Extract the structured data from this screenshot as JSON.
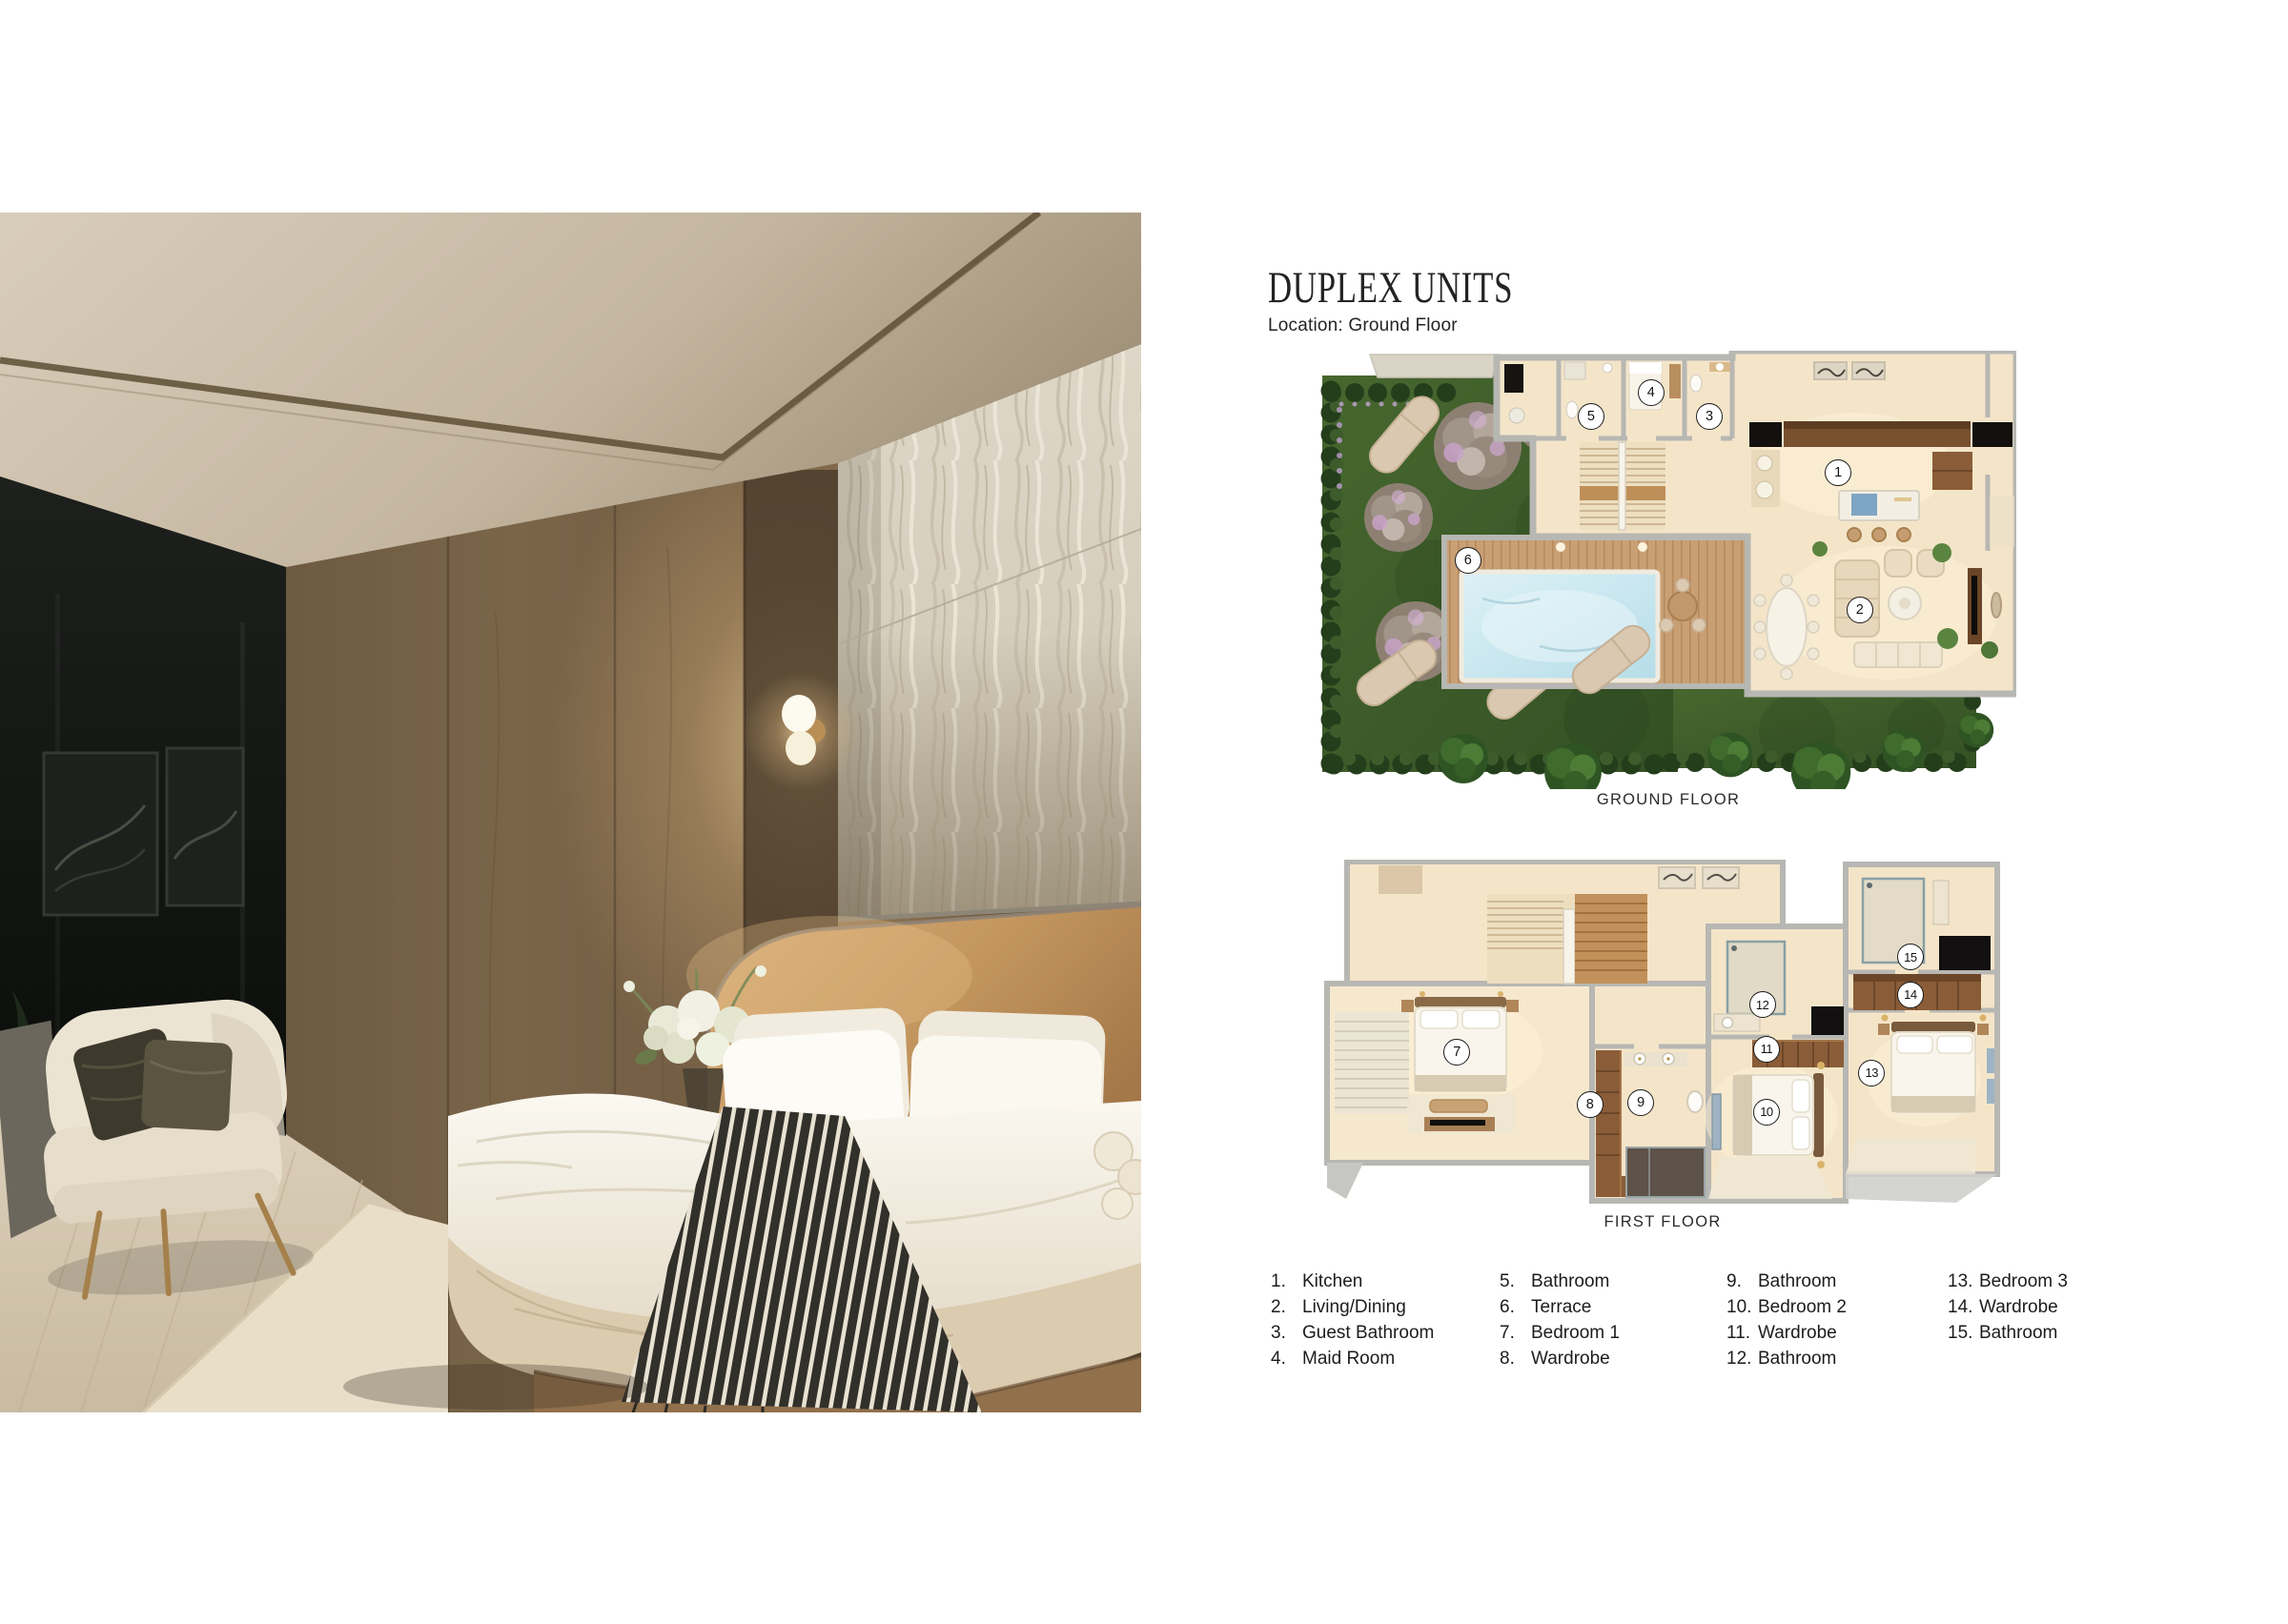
{
  "header": {
    "title": "DUPLEX UNITS",
    "location": "Location: Ground Floor"
  },
  "plans": {
    "ground": {
      "caption": "GROUND FLOOR",
      "markers": [
        {
          "n": "1",
          "x": 74.4,
          "y": 27.8
        },
        {
          "n": "2",
          "x": 77.5,
          "y": 59.1
        },
        {
          "n": "3",
          "x": 55.9,
          "y": 15.0
        },
        {
          "n": "4",
          "x": 47.5,
          "y": 9.6
        },
        {
          "n": "5",
          "x": 38.9,
          "y": 15.0
        },
        {
          "n": "6",
          "x": 21.2,
          "y": 47.8
        }
      ]
    },
    "first": {
      "caption": "FIRST FLOOR",
      "markers": [
        {
          "n": "7",
          "x": 19.7,
          "y": 55.7
        },
        {
          "n": "8",
          "x": 39.3,
          "y": 70.8
        },
        {
          "n": "9",
          "x": 46.8,
          "y": 70.2
        },
        {
          "n": "10",
          "x": 65.3,
          "y": 73.0
        },
        {
          "n": "11",
          "x": 65.3,
          "y": 54.8
        },
        {
          "n": "12",
          "x": 64.7,
          "y": 41.9
        },
        {
          "n": "13",
          "x": 80.8,
          "y": 61.7
        },
        {
          "n": "14",
          "x": 86.5,
          "y": 39.1
        },
        {
          "n": "15",
          "x": 86.5,
          "y": 28.1
        }
      ]
    }
  },
  "legend": {
    "columns": [
      [
        {
          "n": "1.",
          "label": "Kitchen"
        },
        {
          "n": "2.",
          "label": "Living/Dining"
        },
        {
          "n": "3.",
          "label": "Guest Bathroom"
        },
        {
          "n": "4.",
          "label": "Maid Room"
        }
      ],
      [
        {
          "n": "5.",
          "label": "Bathroom"
        },
        {
          "n": "6.",
          "label": "Terrace"
        },
        {
          "n": "7.",
          "label": "Bedroom 1"
        },
        {
          "n": "8.",
          "label": "Wardrobe"
        }
      ],
      [
        {
          "n": "9.",
          "label": "Bathroom"
        },
        {
          "n": "10.",
          "label": "Bedroom 2"
        },
        {
          "n": "11.",
          "label": "Wardrobe"
        },
        {
          "n": "12.",
          "label": "Bathroom"
        }
      ],
      [
        {
          "n": "13.",
          "label": "Bedroom 3"
        },
        {
          "n": "14.",
          "label": "Wardrobe"
        },
        {
          "n": "15.",
          "label": "Bathroom"
        }
      ]
    ]
  },
  "palette": {
    "wall_gray": "#b7b7b3",
    "floor_beige": "#f4e5c9",
    "grass_green": "#41612f",
    "hedge_green": "#263f1c",
    "pool_blue": "#c9e5ee",
    "deck_wood": "#c99f74",
    "cabinet_brown": "#8a5d38",
    "accent_black": "#131110",
    "marker_border": "#1c1c1c"
  }
}
